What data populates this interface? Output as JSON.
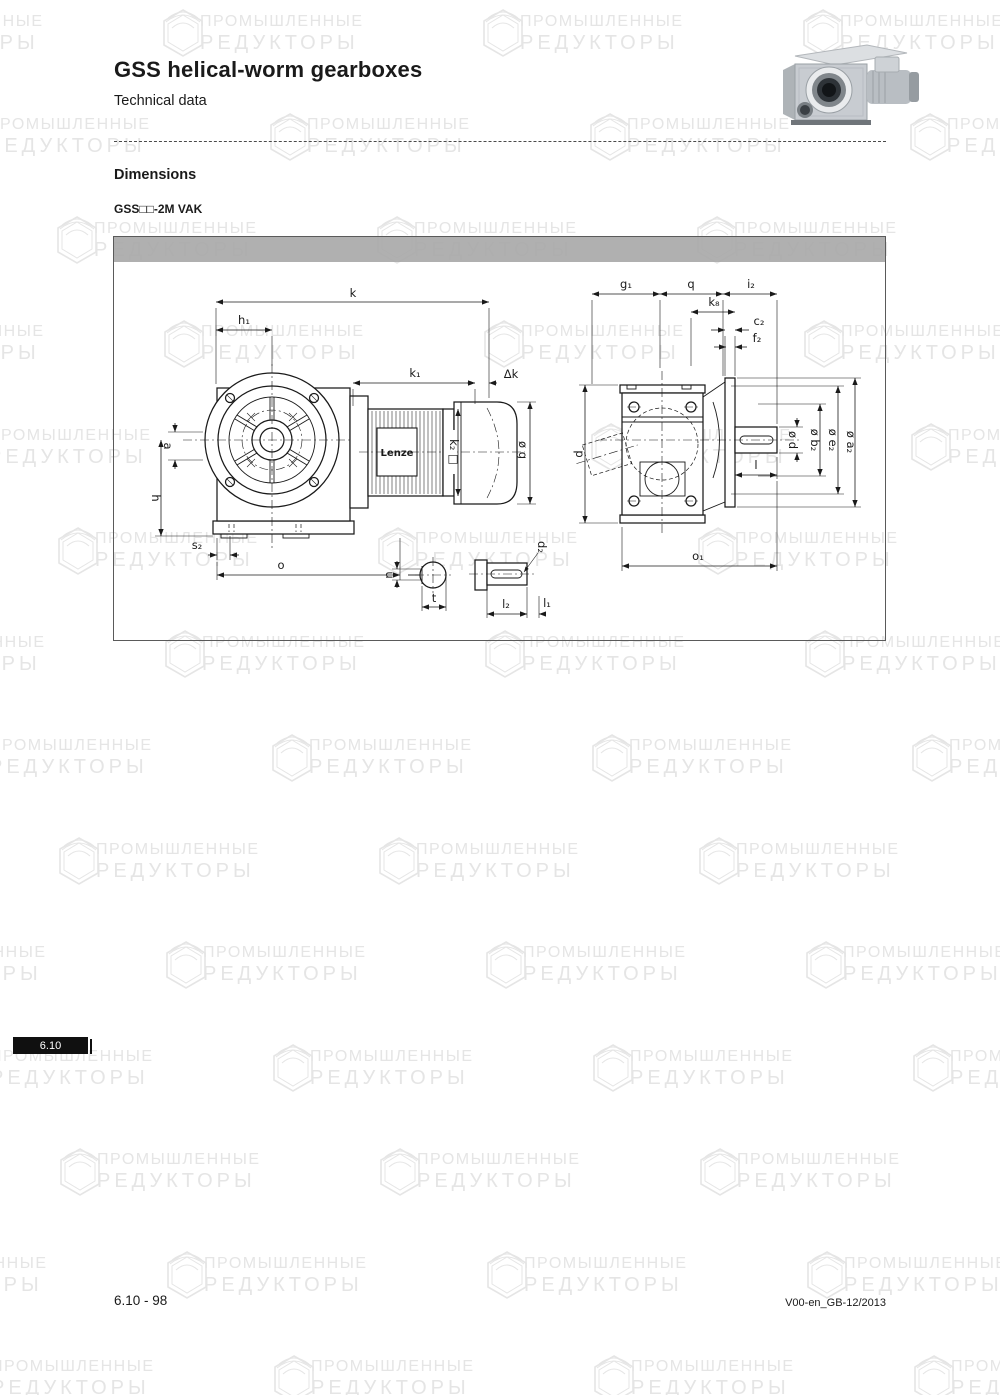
{
  "header": {
    "title": "GSS helical-worm gearboxes",
    "subtitle": "Technical data"
  },
  "section": {
    "heading": "Dimensions",
    "variant": "GSS□□-2M VAK"
  },
  "tab": {
    "label": "6.10"
  },
  "footer": {
    "left": "6.10 - 98",
    "right": "V00-en_GB-12/2013"
  },
  "watermark": {
    "line1": "ПРОМЫШЛЕННЫЕ",
    "line2": "РЕДУКТОРЫ"
  },
  "colors": {
    "watermark": "#e5e5e5",
    "drawing_bar": "#a9a9a9",
    "tab_bg": "#101010"
  },
  "drawing": {
    "brand": "Lenze",
    "labels": {
      "k": "k",
      "h1": "h₁",
      "k1": "k₁",
      "dk": "Δk",
      "a": "a",
      "h": "h",
      "s2": "s₂",
      "o": "o",
      "g": "ø g",
      "k2": "k₂ □",
      "u": "u",
      "t": "t",
      "d2": "d₂",
      "l2": "l₂",
      "l1": "l₁",
      "g1": "g₁",
      "q": "q",
      "i2": "i₂",
      "k8": "k₈",
      "c2": "c₂",
      "f2": "f₂",
      "p": "p",
      "d": "ø d",
      "b2": "ø b₂",
      "e2": "ø e₂",
      "a2": "ø a₂",
      "l": "l",
      "o1": "o₁"
    }
  }
}
